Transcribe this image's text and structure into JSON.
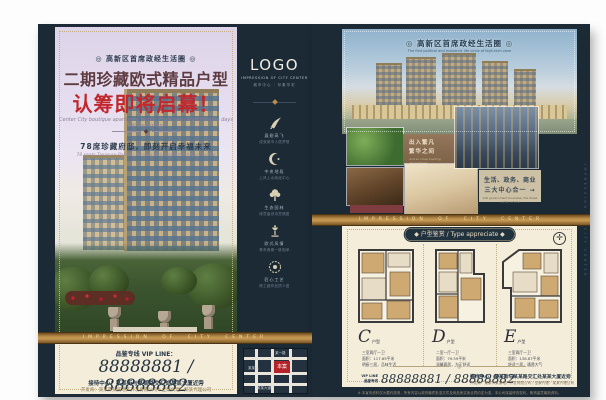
{
  "front": {
    "badge": "◎ 高新区首席政经生活圈 ◎",
    "title": "二期珍藏欧式精品户型",
    "launch_line": "认筹即将启幕！",
    "tagline_en": "Center City boutique apartment layout impression identification days will certain up!",
    "ornament": "◆",
    "feature_cn": "78席珍藏府邸，即刻开启幸福未来",
    "feature_en": "78 seats Treasure Palace, immediately open the happy future",
    "band_text": "IMPRESSION OF CITY CENTER",
    "vip_label": "品鉴专线 VIP LINE：",
    "phones": "88888881 / 88888882",
    "reception": "接待中心：某某街与某某路交汇处某某大厦近旁",
    "developer": "开发商：某某市某某地产开发有限公司 / 全案代理：某某代理公司"
  },
  "sidebar": {
    "logo": "LOGO",
    "logo_sub_en": "IMPRESSION OF CITY CENTER",
    "logo_sub_cn": "城市中心 · 印象华宅",
    "features": [
      {
        "icon": "bird-icon",
        "line1": "展翅高飞",
        "line2": "成就城市人居梦想"
      },
      {
        "icon": "crescent-icon",
        "line1": "中央地段",
        "line2": "上风上水政经中心"
      },
      {
        "icon": "tree-icon",
        "line1": "生态园林",
        "line2": "绿意盎然诗意栖居"
      },
      {
        "icon": "lamp-icon",
        "line1": "欧式风情",
        "line2": "尊贵典雅一脉相承"
      },
      {
        "icon": "medallion-icon",
        "line1": "匠心工艺",
        "line2": "精工细作品质人居"
      }
    ],
    "map": {
      "site_label": "本案",
      "road_top": "某一路",
      "road_mid": "某某路",
      "road_bottom": "某某大道"
    }
  },
  "back": {
    "badge": "◎ 高新区首席政经生活圈 ◎",
    "badge_sub": "The first political and economic life circle of high-tech zone",
    "caption1_line1": "出入繁凡",
    "caption1_line2": "繁华之间",
    "caption1_en": "And so close bustling atmosphere",
    "caption2_line1": "生活、政务、商业",
    "caption2_line2": "三大中心合一 →",
    "caption2_en": "Life government business, the three center of one",
    "band_text": "IMPRESSION OF CITY CENTER",
    "plans_title": "◆ 户型鉴赏 / Type appreciate ◆",
    "plans": [
      {
        "letter": "C",
        "suffix": "户型",
        "rooms": "三室两厅一卫",
        "area": "面积：117.65平米",
        "desc": "明厨三居，品味生活"
      },
      {
        "letter": "D",
        "suffix": "户型",
        "rooms": "二室一厅一卫",
        "area": "面积：79.59平米",
        "desc": "温馨两居，方正舒适"
      },
      {
        "letter": "E",
        "suffix": "户型",
        "rooms": "三室两厅一卫",
        "area": "面积：138.87平米",
        "desc": "舒适三居，通透大气"
      }
    ],
    "compass_glyph": "✛",
    "vip_line1": "VIP LINE",
    "vip_line2": "品鉴专线",
    "phones": "88888881 / 88888882",
    "reception": "接待中心：某某街与某某路交汇处某某大厦近旁",
    "developer": "开发商：某某市某某地产开发有限公司 / 全案代理：某某代理公司",
    "disclaimer": "※ 本宣传资料仅为要约邀请，所有内容以政府最终批准文件及商品房买卖合同约定为准，本公司保留修改权利，敬请留意最新资料。",
    "edge_text": "IMPRESSION OF CITY CENTER"
  }
}
